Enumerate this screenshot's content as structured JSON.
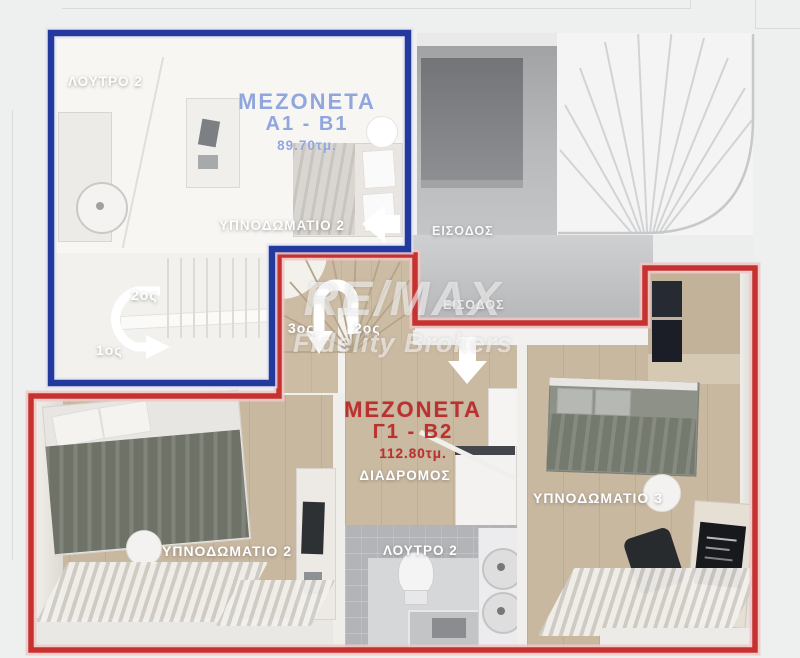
{
  "watermark": {
    "line1": "RE/MAX",
    "line2": "Fidelity Brokers"
  },
  "entrances": {
    "upper": "ΕΙΣΟΔΟΣ",
    "lower": "ΕΙΣΟΔΟΣ"
  },
  "units": {
    "blue": {
      "title": "ΜΕΖΟΝΕΤΑ",
      "code": "A1 - B1",
      "area": "89.70τμ.",
      "outline_color": "#24399d",
      "rooms": {
        "bathroom": "ΛΟΥΤΡΟ 2",
        "bedroom": "ΥΠΝΟΔΩΜΑΤΙΟ 2"
      },
      "floors": {
        "upper": "2ος",
        "lower": "1ος"
      }
    },
    "red": {
      "title": "ΜΕΖΟΝΕΤΑ",
      "code": "Γ1 - Β2",
      "area": "112.80τμ.",
      "outline_color": "#c53230",
      "rooms": {
        "hallway": "ΔΙΑΔΡΟΜΟΣ",
        "bedroom2": "ΥΠΝΟΔΩΜΑΤΙΟ 2",
        "bathroom": "ΛΟΥΤΡΟ 2",
        "bedroom3": "ΥΠΝΟΔΩΜΑΤΙΟ 3"
      },
      "floors": {
        "upper": "3ος",
        "lower": "2ος"
      }
    }
  }
}
